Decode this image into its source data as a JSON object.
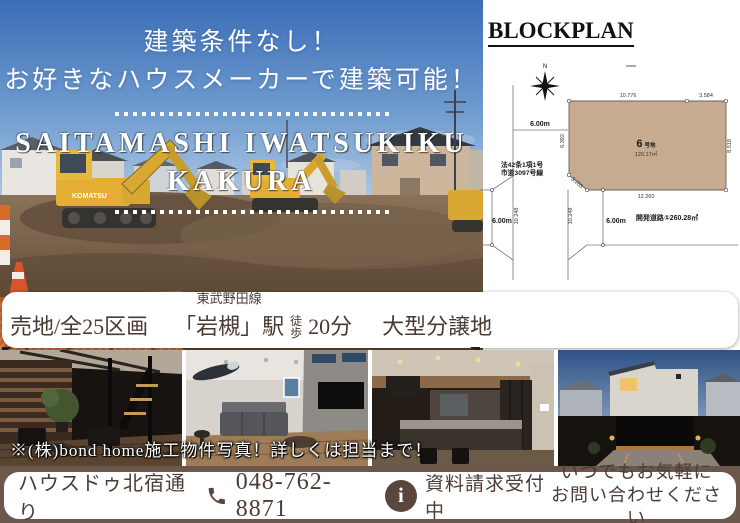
{
  "hero": {
    "headline1": "建築条件なし！",
    "headline2": "お好きなハウスメーカーで建築可能！",
    "site_name1": "SAITAMASHI IWATSUKIKU",
    "site_name2": "KAKURA",
    "excavator_brand": "KOMATSU"
  },
  "blockplan": {
    "title": "BLOCKPLAN",
    "north": "N",
    "lot_number": "6",
    "lot_suffix": "号地",
    "lot_area": "120.17㎡",
    "dim_top_main": "10.776",
    "dim_top_right": "3.584",
    "dim_left": "6.392",
    "dim_chamfer": "3.203",
    "dim_right": "8.518",
    "dim_bottom": "12.260",
    "road_width_top": "6.00m",
    "road_width_left": "6.00m",
    "road_width_center": "6.00m",
    "road_len_left": "10.248",
    "road_len_center": "10.248",
    "road_note1": "法42条1項1号",
    "road_note2": "市道3097号線",
    "dev_road": "開発道路①260.28㎡"
  },
  "info_band": {
    "sale_type": "売地/全25区画",
    "rail_line": "東武野田線",
    "station": "「岩槻」駅",
    "walk_char1": "徒",
    "walk_char2": "歩",
    "walk_time": "20分",
    "category": "大型分譲地"
  },
  "photos": {
    "caption": "※(株)bond home施工物件写真！詳しくは担当まで！"
  },
  "footer": {
    "shop_name": "ハウスドゥ北宿通り",
    "phone": "048-762-8871",
    "request_label": "資料請求受付中",
    "cta_line1": "いつでもお気軽に",
    "cta_line2": "お問い合わせください"
  },
  "icons": {
    "info_glyph": "i"
  },
  "colors": {
    "accent_brown": "#5a463c",
    "footer_bg": "#6b574b",
    "lot_fill": "#c6ab90",
    "sky_top": "#3b6db6",
    "fence_orange": "#cf6d36"
  }
}
